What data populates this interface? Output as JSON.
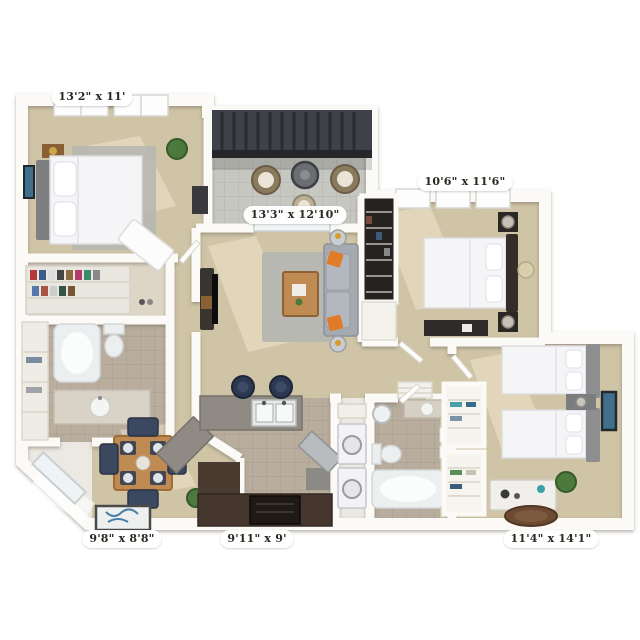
{
  "image_type": "3d-apartment-floor-plan",
  "colors": {
    "wall": "#fbfaf6",
    "carpet": "#cfc4a5",
    "tile": "#b9ad9e",
    "tile_cool": "#c7c7c2",
    "rug": "#b7b8b2",
    "wood": "#c08b52",
    "cabinet_dark": "#46372e",
    "sofa": "#a4aab0",
    "pillow_orange": "#e07b28",
    "navy": "#2d3a52",
    "pergola": "#3e4147",
    "plant": "#4c7a3d",
    "art_blue": "#3f6f8a",
    "headboard_dark": "#332e2a",
    "headboard_gray": "#8e8e90",
    "fixture_white": "#eceff0",
    "label_text": "#2b2820"
  },
  "rooms": {
    "bedroom_top_left": {
      "name": "bedroom",
      "dimensions": "13'2\" x 11'",
      "furniture": [
        "queen-bed",
        "area-rug",
        "nightstand",
        "wall-art",
        "plant",
        "throw-blanket",
        "walk-in-closet"
      ]
    },
    "living_room": {
      "name": "living-room",
      "dimensions": "13'3\" x 12'10\"",
      "furniture": [
        "sofa",
        "orange-pillows",
        "coffee-table",
        "area-rug",
        "tv-console",
        "side-tables"
      ]
    },
    "bedroom_top_right": {
      "name": "bedroom",
      "dimensions": "10'6\" x 11'6\"",
      "furniture": [
        "queen-bed",
        "nightstands",
        "lamps",
        "dresser",
        "closet",
        "tray-table"
      ]
    },
    "dining_room": {
      "name": "dining-area",
      "dimensions": "9'8\" x 8'8\"",
      "furniture": [
        "dining-table",
        "four-chairs",
        "doormat",
        "plant"
      ]
    },
    "kitchen": {
      "name": "kitchen",
      "dimensions": "9'11\" x 9'",
      "furniture": [
        "breakfast-bar",
        "double-sink",
        "bar-stools",
        "lower-cabinets",
        "oven"
      ]
    },
    "bedroom_bottom_right": {
      "name": "bedroom",
      "dimensions": "11'4\" x 14'1\"",
      "furniture": [
        "twin-bed",
        "twin-bed",
        "nightstand",
        "wall-art",
        "dresser",
        "round-rug",
        "plant",
        "linen-closets"
      ]
    },
    "balcony": {
      "name": "balcony",
      "furniture": [
        "pergola",
        "patio-table",
        "wicker-chairs",
        "stool"
      ]
    },
    "bathroom_left": {
      "name": "bathroom",
      "furniture": [
        "bathtub",
        "toilet",
        "vanity-sink",
        "linen-shelves"
      ]
    },
    "bathroom_right": {
      "name": "bathroom",
      "furniture": [
        "bathtub",
        "toilet",
        "vanity-sink",
        "round-mirror",
        "towels"
      ]
    },
    "laundry": {
      "name": "laundry-closet",
      "furniture": [
        "washer",
        "dryer",
        "shelf"
      ]
    }
  }
}
